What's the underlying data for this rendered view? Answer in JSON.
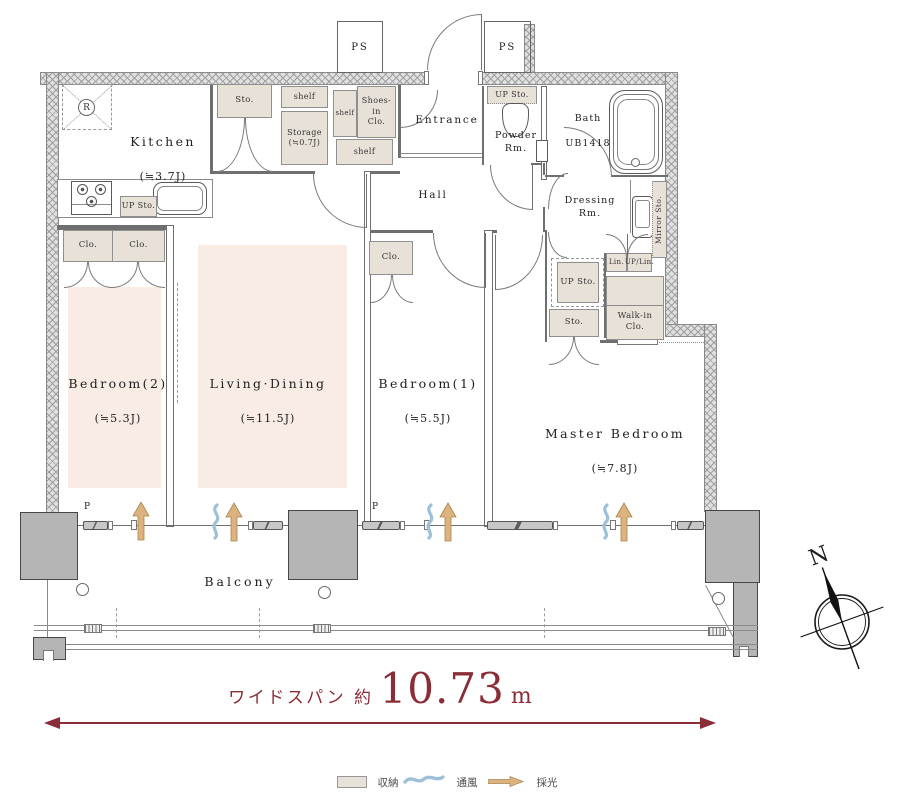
{
  "labels": {
    "ps": "PS",
    "sto": "Sto.",
    "shelf": "shelf",
    "up_sto": "UP Sto.",
    "clo": "Clo.",
    "lin": "Lin.",
    "up_lin": "UP/Lin.",
    "mirror_sto": "Mirror Sto.",
    "shoes_in_clo": "Shoes-in\nClo.",
    "walk_in_clo": "Walk-in\nClo.",
    "r": "R",
    "p": "P",
    "n": "N",
    "balcony": "Balcony"
  },
  "rooms": {
    "kitchen": {
      "name": "Kitchen",
      "size": "(≒3.7J)"
    },
    "storage": {
      "name": "Storage",
      "size": "(≒0.7J)"
    },
    "entrance": {
      "name": "Entrance"
    },
    "hall": {
      "name": "Hall"
    },
    "powder": {
      "name": "Powder\nRm."
    },
    "bath": {
      "name": "Bath",
      "model": "UB1418"
    },
    "dressing": {
      "name": "Dressing\nRm."
    },
    "bedroom2": {
      "name": "Bedroom(2)",
      "size": "(≒5.3J)"
    },
    "living": {
      "name": "Living·Dining",
      "size": "(≒11.5J)"
    },
    "bedroom1": {
      "name": "Bedroom(1)",
      "size": "(≒5.5J)"
    },
    "master": {
      "name": "Master Bedroom",
      "size": "(≒7.8J)"
    }
  },
  "dimension": {
    "label": "ワイドスパン 約",
    "value": "10.73",
    "unit": "m"
  },
  "legend": {
    "storage": "収納",
    "ventilation": "通風",
    "daylight": "採光"
  },
  "colors": {
    "accent": "#8b2d36",
    "storage_fill": "#e8e1d8",
    "room_fill": "#f8ece5",
    "wave": "#9cc0da",
    "daylight_arrow": "#dcb27e",
    "wall_line": "#6f6f6f"
  }
}
